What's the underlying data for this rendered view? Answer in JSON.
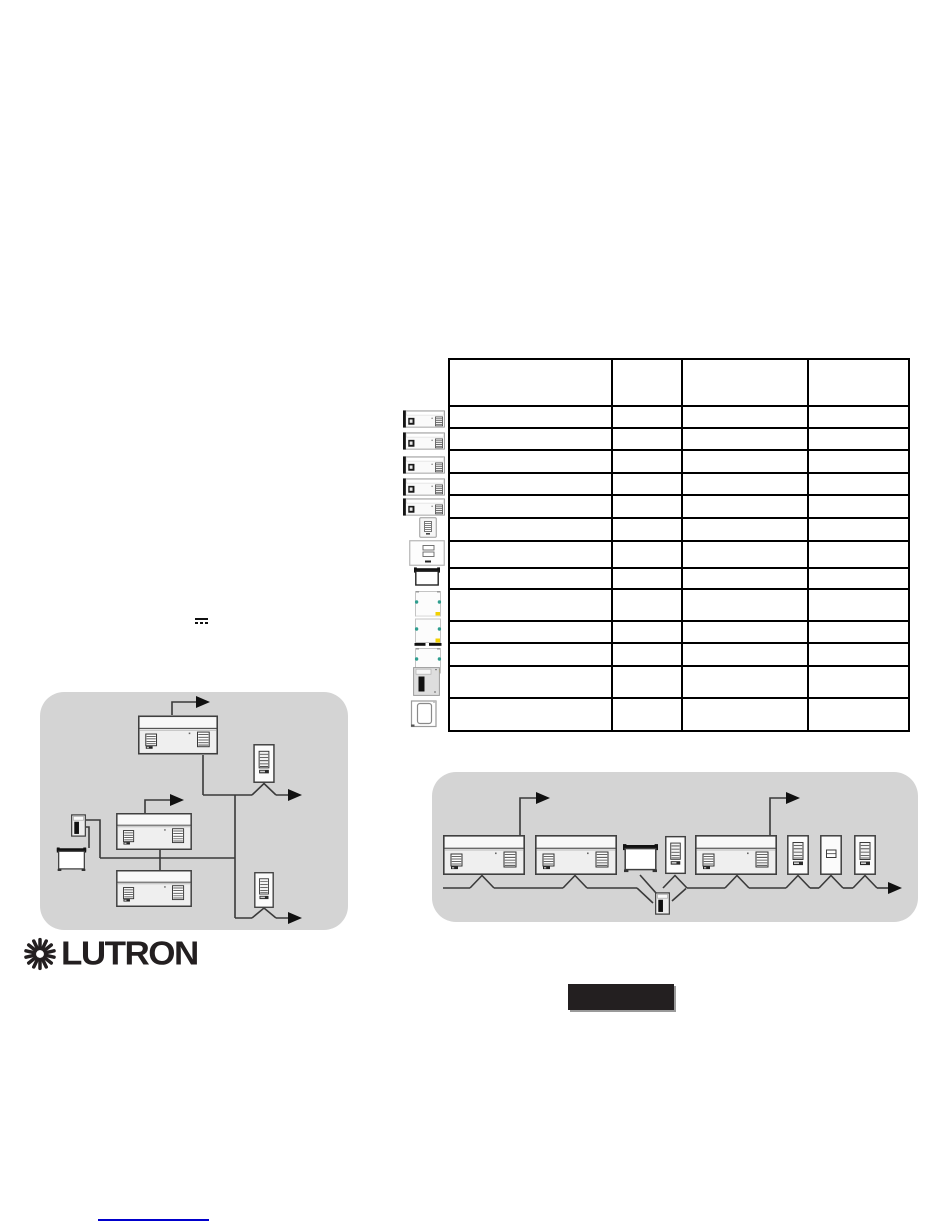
{
  "page": {
    "background": "#ffffff"
  },
  "logo": {
    "label": "LUTRON",
    "icon": "sunburst-icon"
  },
  "colors": {
    "diagram_background": "#d4d4d4",
    "table_border": "#000000",
    "link": "#0000cc",
    "redaction": "#231f20",
    "shade_dot_teal": "#2f9e8f",
    "shade_dot_yellow": "#f2d100"
  },
  "symbols": {
    "dc_power": "solid bar over dashed bar"
  },
  "table": {
    "header": {
      "height": 47,
      "cells": [
        "",
        "",
        "",
        ""
      ]
    },
    "col_widths": [
      163,
      70,
      126,
      101
    ],
    "rows": [
      {
        "icon": "power-module-icon",
        "height": 22,
        "cells": [
          "",
          "",
          "",
          ""
        ]
      },
      {
        "icon": "power-module-icon",
        "height": 22,
        "cells": [
          "",
          "",
          "",
          ""
        ]
      },
      {
        "icon": "power-module-icon",
        "height": 23,
        "cells": [
          "",
          "",
          "",
          ""
        ]
      },
      {
        "icon": "power-module-icon",
        "height": 22,
        "cells": [
          "",
          "",
          "",
          ""
        ]
      },
      {
        "icon": "power-module-icon",
        "height": 23,
        "cells": [
          "",
          "",
          "",
          ""
        ]
      },
      {
        "icon": "keypad-icon",
        "height": 23,
        "cells": [
          "",
          "",
          "",
          ""
        ]
      },
      {
        "icon": "wallstation-icon",
        "height": 27,
        "cells": [
          "",
          "",
          "",
          ""
        ]
      },
      {
        "icon": "projection-screen-icon",
        "height": 21,
        "cells": [
          "",
          "",
          "",
          ""
        ]
      },
      {
        "icon": "shade-module-icon",
        "height": 32,
        "cells": [
          "",
          "",
          "",
          ""
        ]
      },
      {
        "icon": "shade-module-dark-icon",
        "height": 22,
        "cells": [
          "",
          "",
          "",
          ""
        ]
      },
      {
        "icon": "shade-module-icon",
        "height": 23,
        "cells": [
          "",
          "",
          "",
          ""
        ]
      },
      {
        "icon": "power-interface-icon",
        "height": 32,
        "cells": [
          "",
          "",
          "",
          ""
        ]
      },
      {
        "icon": "device-outline-icon",
        "height": 33,
        "cells": [
          "",
          "",
          "",
          ""
        ]
      }
    ],
    "icon_placements": [
      {
        "sym": "power-module",
        "name": "power-module-icon",
        "x": 403,
        "y": 410,
        "w": 42,
        "h": 18
      },
      {
        "sym": "power-module",
        "name": "power-module-icon",
        "x": 403,
        "y": 432,
        "w": 42,
        "h": 18
      },
      {
        "sym": "power-module",
        "name": "power-module-icon",
        "x": 403,
        "y": 456,
        "w": 42,
        "h": 18
      },
      {
        "sym": "power-module",
        "name": "power-module-icon",
        "x": 403,
        "y": 478,
        "w": 42,
        "h": 18
      },
      {
        "sym": "power-module",
        "name": "power-module-icon",
        "x": 403,
        "y": 498,
        "w": 42,
        "h": 18
      },
      {
        "sym": "keypad-small",
        "name": "keypad-icon",
        "x": 419,
        "y": 517,
        "w": 18,
        "h": 21
      },
      {
        "sym": "wallstation",
        "name": "wallstation-icon",
        "x": 409,
        "y": 540,
        "w": 36,
        "h": 26
      },
      {
        "sym": "screen",
        "name": "projection-screen-icon",
        "x": 414,
        "y": 567,
        "w": 26,
        "h": 20
      },
      {
        "sym": "shade",
        "name": "shade-module-icon",
        "x": 414,
        "y": 590,
        "w": 28,
        "h": 28
      },
      {
        "sym": "shade-dark",
        "name": "shade-module-dark-icon",
        "x": 414,
        "y": 618,
        "w": 28,
        "h": 28
      },
      {
        "sym": "shade",
        "name": "shade-module-icon",
        "x": 414,
        "y": 647,
        "w": 28,
        "h": 28
      },
      {
        "sym": "power-interface",
        "name": "power-interface-icon",
        "x": 413,
        "y": 667,
        "w": 27,
        "h": 29
      },
      {
        "sym": "device-outline",
        "name": "device-outline-icon",
        "x": 410,
        "y": 700,
        "w": 28,
        "h": 28
      }
    ]
  },
  "diagram_left": {
    "devices": [
      "power-module",
      "keypad",
      "power-module",
      "control-interface",
      "projection-screen",
      "power-module",
      "keypad"
    ]
  },
  "diagram_right": {
    "devices": [
      "power-module",
      "power-module",
      "projection-screen",
      "keypad",
      "power-module",
      "keypad",
      "keypad",
      "keypad",
      "control-interface"
    ]
  },
  "footer": {
    "link_label": ""
  }
}
